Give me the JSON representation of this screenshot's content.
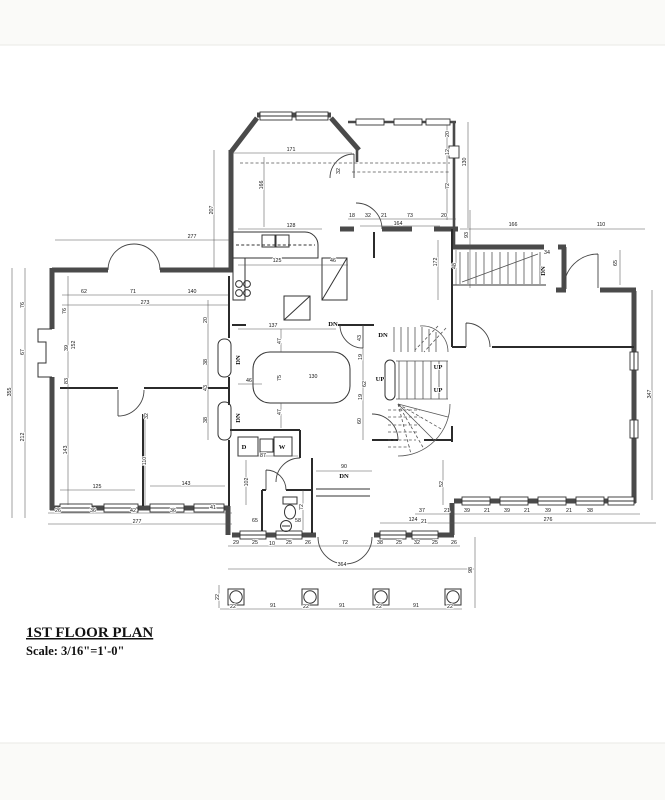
{
  "title_block": {
    "title": "1ST FLOOR PLAN",
    "scale": "Scale: 3/16\"=1'-0\""
  },
  "plan_labels": [
    {
      "t": "DN",
      "x": 333,
      "y": 326,
      "v": 0
    },
    {
      "t": "DN",
      "x": 383,
      "y": 337,
      "v": 0
    },
    {
      "t": "DN",
      "x": 240,
      "y": 360,
      "v": 1
    },
    {
      "t": "DN",
      "x": 240,
      "y": 418,
      "v": 1
    },
    {
      "t": "UP",
      "x": 380,
      "y": 381,
      "v": 0
    },
    {
      "t": "UP",
      "x": 438,
      "y": 369,
      "v": 0
    },
    {
      "t": "UP",
      "x": 438,
      "y": 392,
      "v": 0
    },
    {
      "t": "DN",
      "x": 545,
      "y": 271,
      "v": 1
    },
    {
      "t": "DN",
      "x": 344,
      "y": 478,
      "v": 0
    },
    {
      "t": "D",
      "x": 244,
      "y": 449,
      "v": 0
    },
    {
      "t": "W",
      "x": 282,
      "y": 449,
      "v": 0
    }
  ],
  "dims": [
    {
      "t": "171",
      "x": 291,
      "y": 151,
      "v": 0
    },
    {
      "t": "166",
      "x": 263,
      "y": 185,
      "v": 1
    },
    {
      "t": "207",
      "x": 213,
      "y": 210,
      "v": 1
    },
    {
      "t": "128",
      "x": 291,
      "y": 227,
      "v": 0
    },
    {
      "t": "125",
      "x": 277,
      "y": 262,
      "v": 0
    },
    {
      "t": "46",
      "x": 333,
      "y": 262,
      "v": 0
    },
    {
      "t": "32",
      "x": 340,
      "y": 171,
      "v": 1
    },
    {
      "t": "172",
      "x": 437,
      "y": 262,
      "v": 1
    },
    {
      "t": "20",
      "x": 449,
      "y": 134,
      "v": 1
    },
    {
      "t": "12",
      "x": 449,
      "y": 152,
      "v": 1
    },
    {
      "t": "72",
      "x": 449,
      "y": 186,
      "v": 1
    },
    {
      "t": "130",
      "x": 466,
      "y": 162,
      "v": 1
    },
    {
      "t": "18",
      "x": 352,
      "y": 217,
      "v": 0
    },
    {
      "t": "32",
      "x": 368,
      "y": 217,
      "v": 0
    },
    {
      "t": "21",
      "x": 384,
      "y": 217,
      "v": 0
    },
    {
      "t": "73",
      "x": 410,
      "y": 217,
      "v": 0
    },
    {
      "t": "20",
      "x": 444,
      "y": 217,
      "v": 0
    },
    {
      "t": "164",
      "x": 398,
      "y": 225,
      "v": 0
    },
    {
      "t": "93",
      "x": 468,
      "y": 235,
      "v": 1
    },
    {
      "t": "166",
      "x": 513,
      "y": 226,
      "v": 0
    },
    {
      "t": "110",
      "x": 601,
      "y": 226,
      "v": 0
    },
    {
      "t": "34",
      "x": 547,
      "y": 254,
      "v": 0
    },
    {
      "t": "65",
      "x": 617,
      "y": 263,
      "v": 1
    },
    {
      "t": "48",
      "x": 456,
      "y": 266,
      "v": 1
    },
    {
      "t": "277",
      "x": 192,
      "y": 238,
      "v": 0
    },
    {
      "t": "62",
      "x": 84,
      "y": 293,
      "v": 0
    },
    {
      "t": "71",
      "x": 133,
      "y": 293,
      "v": 0
    },
    {
      "t": "140",
      "x": 192,
      "y": 293,
      "v": 0
    },
    {
      "t": "273",
      "x": 145,
      "y": 304,
      "v": 0
    },
    {
      "t": "76",
      "x": 66,
      "y": 311,
      "v": 1
    },
    {
      "t": "39",
      "x": 68,
      "y": 348,
      "v": 1
    },
    {
      "t": "152",
      "x": 75,
      "y": 345,
      "v": 1
    },
    {
      "t": "83",
      "x": 68,
      "y": 381,
      "v": 1
    },
    {
      "t": "143",
      "x": 67,
      "y": 450,
      "v": 1
    },
    {
      "t": "355",
      "x": 11,
      "y": 392,
      "v": 1
    },
    {
      "t": "76",
      "x": 24,
      "y": 305,
      "v": 1
    },
    {
      "t": "67",
      "x": 24,
      "y": 352,
      "v": 1
    },
    {
      "t": "212",
      "x": 24,
      "y": 437,
      "v": 1
    },
    {
      "t": "20",
      "x": 207,
      "y": 320,
      "v": 1
    },
    {
      "t": "38",
      "x": 207,
      "y": 362,
      "v": 1
    },
    {
      "t": "43",
      "x": 207,
      "y": 388,
      "v": 1
    },
    {
      "t": "38",
      "x": 207,
      "y": 420,
      "v": 1
    },
    {
      "t": "32",
      "x": 148,
      "y": 416,
      "v": 1
    },
    {
      "t": "110",
      "x": 146,
      "y": 461,
      "v": 1
    },
    {
      "t": "125",
      "x": 97,
      "y": 488,
      "v": 0
    },
    {
      "t": "143",
      "x": 186,
      "y": 485,
      "v": 0
    },
    {
      "t": "26",
      "x": 58,
      "y": 512,
      "v": 0
    },
    {
      "t": "36",
      "x": 93,
      "y": 512,
      "v": 0
    },
    {
      "t": "42",
      "x": 133,
      "y": 512,
      "v": 0
    },
    {
      "t": "36",
      "x": 173,
      "y": 512,
      "v": 0
    },
    {
      "t": "41",
      "x": 213,
      "y": 509,
      "v": 0
    },
    {
      "t": "277",
      "x": 137,
      "y": 523,
      "v": 0
    },
    {
      "t": "137",
      "x": 273,
      "y": 327,
      "v": 0
    },
    {
      "t": "47",
      "x": 281,
      "y": 341,
      "v": 1
    },
    {
      "t": "47",
      "x": 281,
      "y": 412,
      "v": 1
    },
    {
      "t": "46",
      "x": 249,
      "y": 382,
      "v": 0
    },
    {
      "t": "75",
      "x": 281,
      "y": 378,
      "v": 1
    },
    {
      "t": "130",
      "x": 313,
      "y": 378,
      "v": 0
    },
    {
      "t": "43",
      "x": 361,
      "y": 338,
      "v": 1
    },
    {
      "t": "19",
      "x": 362,
      "y": 357,
      "v": 1
    },
    {
      "t": "62",
      "x": 366,
      "y": 384,
      "v": 1
    },
    {
      "t": "19",
      "x": 362,
      "y": 397,
      "v": 1
    },
    {
      "t": "60",
      "x": 361,
      "y": 421,
      "v": 1
    },
    {
      "t": "87",
      "x": 263,
      "y": 457,
      "v": 0
    },
    {
      "t": "102",
      "x": 248,
      "y": 482,
      "v": 1
    },
    {
      "t": "65",
      "x": 255,
      "y": 522,
      "v": 0
    },
    {
      "t": "58",
      "x": 298,
      "y": 522,
      "v": 0
    },
    {
      "t": "72",
      "x": 303,
      "y": 507,
      "v": 1
    },
    {
      "t": "90",
      "x": 344,
      "y": 468,
      "v": 0
    },
    {
      "t": "124",
      "x": 413,
      "y": 521,
      "v": 0
    },
    {
      "t": "52",
      "x": 443,
      "y": 484,
      "v": 1
    },
    {
      "t": "29",
      "x": 236,
      "y": 544,
      "v": 0
    },
    {
      "t": "25",
      "x": 255,
      "y": 544,
      "v": 0
    },
    {
      "t": "10",
      "x": 272,
      "y": 545,
      "v": 0
    },
    {
      "t": "25",
      "x": 289,
      "y": 544,
      "v": 0
    },
    {
      "t": "26",
      "x": 308,
      "y": 544,
      "v": 0
    },
    {
      "t": "72",
      "x": 345,
      "y": 544,
      "v": 0
    },
    {
      "t": "38",
      "x": 380,
      "y": 544,
      "v": 0
    },
    {
      "t": "25",
      "x": 399,
      "y": 544,
      "v": 0
    },
    {
      "t": "32",
      "x": 417,
      "y": 544,
      "v": 0
    },
    {
      "t": "25",
      "x": 435,
      "y": 544,
      "v": 0
    },
    {
      "t": "26",
      "x": 454,
      "y": 544,
      "v": 0
    },
    {
      "t": "364",
      "x": 342,
      "y": 566,
      "v": 0
    },
    {
      "t": "98",
      "x": 472,
      "y": 570,
      "v": 1
    },
    {
      "t": "22",
      "x": 219,
      "y": 597,
      "v": 1
    },
    {
      "t": "22",
      "x": 233,
      "y": 608,
      "v": 0
    },
    {
      "t": "91",
      "x": 273,
      "y": 607,
      "v": 0
    },
    {
      "t": "22",
      "x": 306,
      "y": 608,
      "v": 0
    },
    {
      "t": "91",
      "x": 342,
      "y": 607,
      "v": 0
    },
    {
      "t": "22",
      "x": 379,
      "y": 608,
      "v": 0
    },
    {
      "t": "91",
      "x": 416,
      "y": 607,
      "v": 0
    },
    {
      "t": "22",
      "x": 450,
      "y": 608,
      "v": 0
    },
    {
      "t": "347",
      "x": 651,
      "y": 394,
      "v": 1
    },
    {
      "t": "276",
      "x": 548,
      "y": 521,
      "v": 0
    },
    {
      "t": "37",
      "x": 422,
      "y": 512,
      "v": 0
    },
    {
      "t": "21",
      "x": 447,
      "y": 512,
      "v": 0
    },
    {
      "t": "39",
      "x": 467,
      "y": 512,
      "v": 0
    },
    {
      "t": "21",
      "x": 487,
      "y": 512,
      "v": 0
    },
    {
      "t": "39",
      "x": 507,
      "y": 512,
      "v": 0
    },
    {
      "t": "21",
      "x": 527,
      "y": 512,
      "v": 0
    },
    {
      "t": "39",
      "x": 548,
      "y": 512,
      "v": 0
    },
    {
      "t": "21",
      "x": 569,
      "y": 512,
      "v": 0
    },
    {
      "t": "38",
      "x": 590,
      "y": 512,
      "v": 0
    },
    {
      "t": "21",
      "x": 424,
      "y": 523,
      "v": 0
    }
  ]
}
